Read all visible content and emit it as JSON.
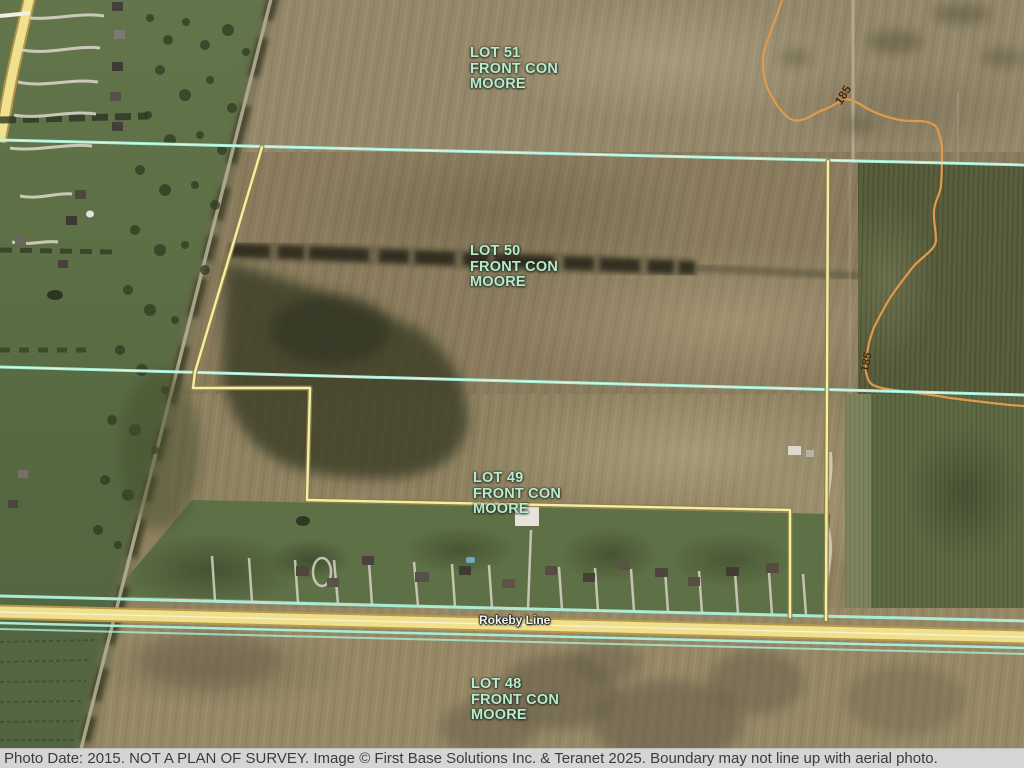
{
  "map": {
    "lots": [
      {
        "id": "lot-51",
        "line1": "LOT 51",
        "line2": "FRONT CON",
        "line3": "MOORE"
      },
      {
        "id": "lot-50",
        "line1": "LOT 50",
        "line2": "FRONT CON",
        "line3": "MOORE"
      },
      {
        "id": "lot-49",
        "line1": "LOT 49",
        "line2": "FRONT CON",
        "line3": "MOORE"
      },
      {
        "id": "lot-48",
        "line1": "LOT 48",
        "line2": "FRONT CON",
        "line3": "MOORE"
      }
    ],
    "road_label": "Rokeby Line",
    "contours": [
      {
        "label": "185"
      },
      {
        "label": "185"
      }
    ],
    "colors": {
      "parcel_boundary": "#f4eeab",
      "lot_line": "#a9ecd6",
      "road_fill": "#f0df8b",
      "contour": "#df9a4b",
      "label_text": "#b4eccd"
    }
  },
  "caption": {
    "text": "Photo Date: 2015. NOT A PLAN OF SURVEY. Image © First Base Solutions Inc. & Teranet 2025. Boundary may not line up with aerial photo."
  }
}
